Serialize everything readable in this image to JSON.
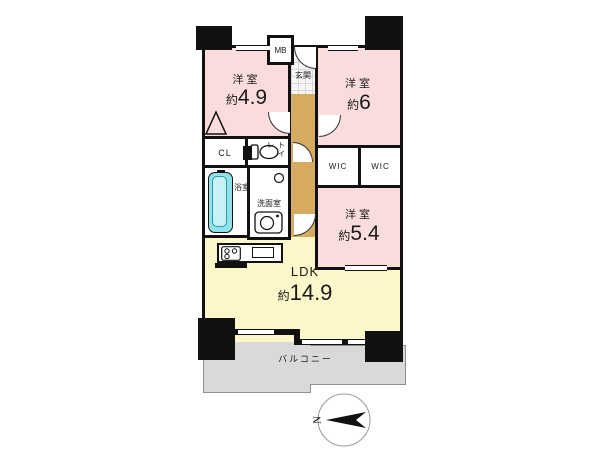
{
  "plan": {
    "rooms": {
      "western1": {
        "label": "洋室",
        "approx": "約",
        "size": "4.9"
      },
      "western2": {
        "label": "洋室",
        "approx": "約",
        "size": "6"
      },
      "western3": {
        "label": "洋室",
        "approx": "約",
        "size": "5.4"
      },
      "ldk": {
        "label": "LDK",
        "approx": "約",
        "size": "14.9"
      }
    },
    "spaces": {
      "balcony": "バルコニー",
      "genkan": "玄関",
      "bath": "浴室",
      "washroom": "洗面室",
      "toilet": "トイレ",
      "closet": "CL",
      "wic_left": "WIC",
      "wic_right": "WIC",
      "meter_box": "MB"
    },
    "compass": {
      "north": "N"
    },
    "colors": {
      "room_pink": "#fadcdc",
      "ldk_yellow": "#fbf7c8",
      "hall_tan": "#d5ab5f",
      "balcony_gray": "#d9d9da",
      "tub_cyan": "#8fe2ea",
      "wall_black": "#111111"
    }
  }
}
